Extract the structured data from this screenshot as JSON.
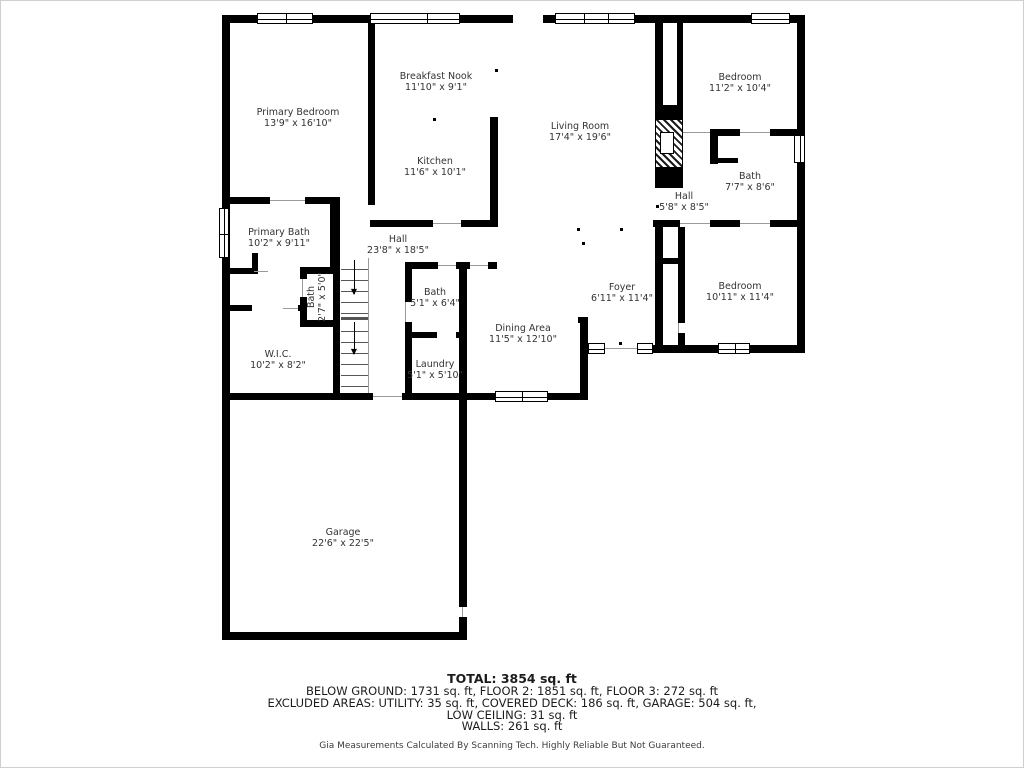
{
  "plan": {
    "rooms": [
      {
        "name": "Primary Bedroom",
        "dims": "13'9\" x 16'10\""
      },
      {
        "name": "Breakfast Nook",
        "dims": "11'10\" x 9'1\""
      },
      {
        "name": "Kitchen",
        "dims": "11'6\" x 10'1\""
      },
      {
        "name": "Living Room",
        "dims": "17'4\" x 19'6\""
      },
      {
        "name": "Bedroom",
        "dims": "11'2\" x 10'4\""
      },
      {
        "name": "Bath",
        "dims": "7'7\" x 8'6\""
      },
      {
        "name": "Hall",
        "dims": "5'8\" x 8'5\""
      },
      {
        "name": "Primary Bath",
        "dims": "10'2\" x 9'11\""
      },
      {
        "name": "Hall",
        "dims": "23'8\" x 18'5\""
      },
      {
        "name": "Bath",
        "dims": "2'7\" x 5'0\""
      },
      {
        "name": "Bath",
        "dims": "5'1\" x 6'4\""
      },
      {
        "name": "Foyer",
        "dims": "6'11\" x 11'4\""
      },
      {
        "name": "Bedroom",
        "dims": "10'11\" x 11'4\""
      },
      {
        "name": "W.I.C.",
        "dims": "10'2\" x 8'2\""
      },
      {
        "name": "Laundry",
        "dims": "5'1\" x 5'10\""
      },
      {
        "name": "Dining Area",
        "dims": "11'5\" x 12'10\""
      },
      {
        "name": "Garage",
        "dims": "22'6\" x 22'5\""
      }
    ],
    "footer": {
      "total": "TOTAL: 3854 sq. ft",
      "floors": "BELOW GROUND: 1731 sq. ft, FLOOR 2: 1851 sq. ft, FLOOR 3: 272 sq. ft",
      "excluded": "EXCLUDED AREAS: UTILITY: 35 sq. ft, COVERED DECK: 186 sq. ft, GARAGE: 504 sq. ft,",
      "low_ceiling": "LOW CEILING: 31 sq. ft",
      "walls": "WALLS: 261 sq. ft",
      "disclaimer": "Gia Measurements Calculated By Scanning Tech. Highly Reliable But Not Guaranteed."
    },
    "icons": {
      "stair_arrow_down": "▼"
    }
  }
}
